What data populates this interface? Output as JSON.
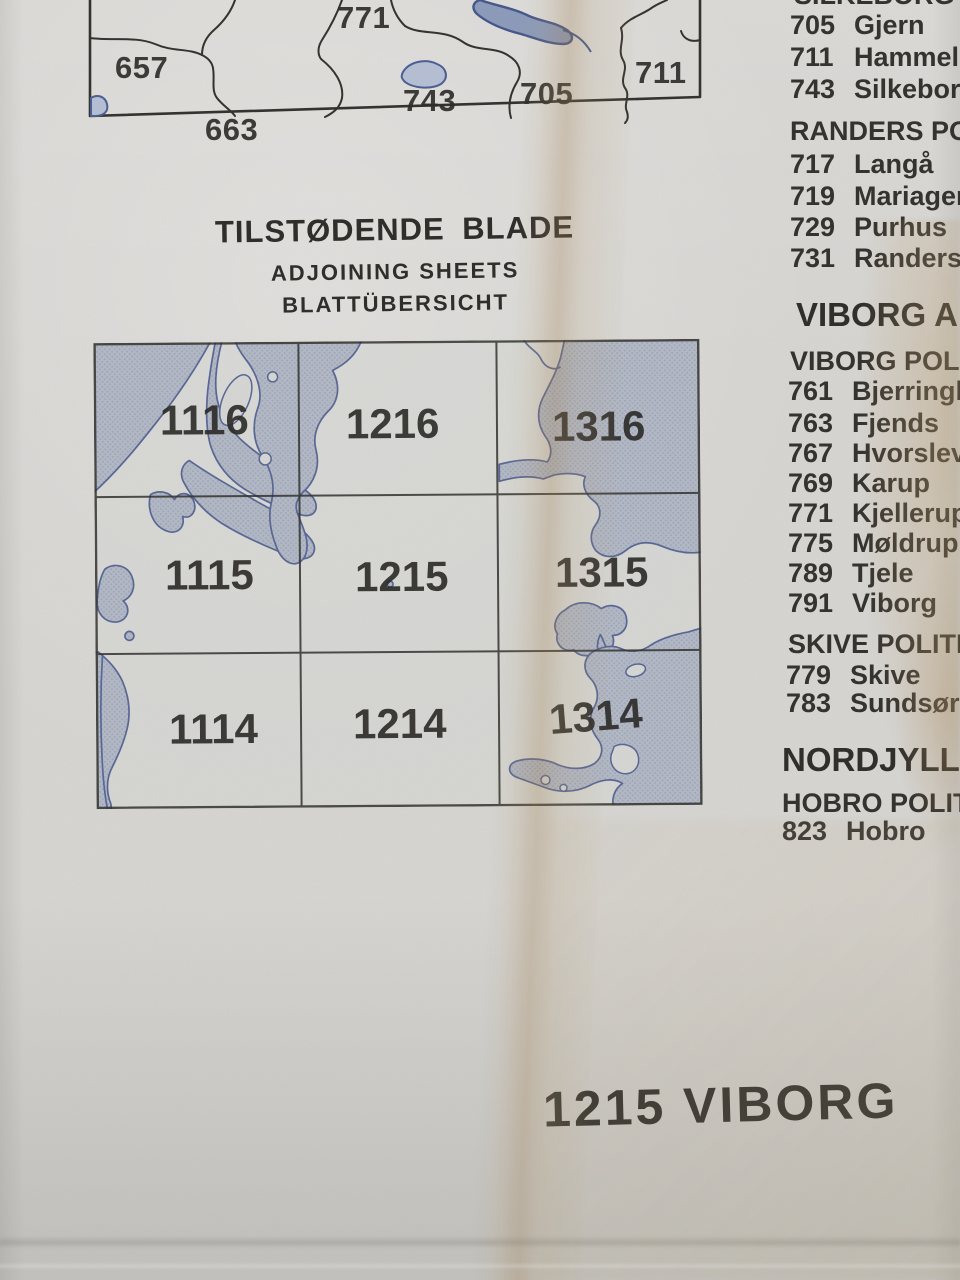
{
  "top_map": {
    "labels": {
      "l771": "771",
      "l657": "657",
      "l743": "743",
      "l705": "705",
      "l711": "711",
      "l663": "663"
    }
  },
  "heading": {
    "danish": "TILSTØDENDE BLADE",
    "english": "ADJOINING SHEETS",
    "german": "BLATTÜBERSICHT"
  },
  "grid": {
    "rows": [
      [
        "1116",
        "1216",
        "1316"
      ],
      [
        "1115",
        "1215",
        "1315"
      ],
      [
        "1114",
        "1214",
        "1314"
      ]
    ]
  },
  "sidebar": {
    "partial_heading": "SILKEBORG POL",
    "s1_items": [
      {
        "code": "705",
        "name": "Gjern"
      },
      {
        "code": "711",
        "name": "Hammel"
      },
      {
        "code": "743",
        "name": "Silkeborg"
      }
    ],
    "randers_heading": "RANDERS POLI",
    "randers_items": [
      {
        "code": "717",
        "name": "Langå"
      },
      {
        "code": "719",
        "name": "Mariager"
      },
      {
        "code": "729",
        "name": "Purhus"
      },
      {
        "code": "731",
        "name": "Randers"
      }
    ],
    "viborg_amt_heading": "VIBORG AMT",
    "viborg_heading": "VIBORG POLITIK",
    "viborg_items": [
      {
        "code": "761",
        "name": "Bjerringbro"
      },
      {
        "code": "763",
        "name": "Fjends"
      },
      {
        "code": "767",
        "name": "Hvorslev"
      },
      {
        "code": "769",
        "name": "Karup"
      },
      {
        "code": "771",
        "name": "Kjellerup"
      },
      {
        "code": "775",
        "name": "Møldrup"
      },
      {
        "code": "789",
        "name": "Tjele"
      },
      {
        "code": "791",
        "name": "Viborg"
      }
    ],
    "skive_heading": "SKIVE POLITIKRE",
    "skive_items": [
      {
        "code": "779",
        "name": "Skive"
      },
      {
        "code": "783",
        "name": "Sundsøre"
      }
    ],
    "nordjylland_heading": "NORDJYLLAN",
    "hobro_heading": "HOBRO POLITIKR",
    "hobro_items": [
      {
        "code": "823",
        "name": "Hobro"
      }
    ]
  },
  "footer": {
    "sheet_title": "1215 VIBORG"
  },
  "colors": {
    "paper": "#d7d6d3",
    "water_fill": "#b4bac6",
    "water_outline": "#5a6896",
    "ink": "#32312d",
    "grid_line": "#34332f",
    "stain": "#b3946a"
  }
}
